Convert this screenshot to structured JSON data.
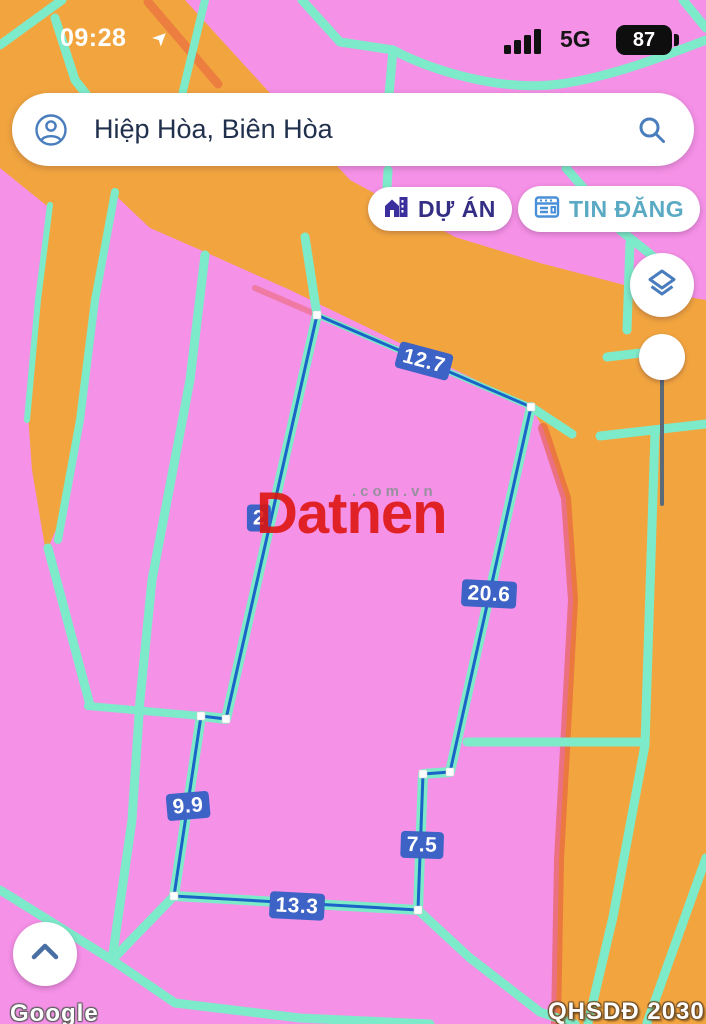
{
  "status_bar": {
    "time": "09:28",
    "network": "5G",
    "battery_percent": "87"
  },
  "search": {
    "value": "Hiệp Hòa, Biên Hòa"
  },
  "actions": {
    "du_an_label": "DỰ ÁN",
    "tin_dang_label": "TIN ĐĂNG"
  },
  "icons": {
    "account": "person-circle",
    "search": "magnifier",
    "du_an": "building",
    "tin_dang": "newspaper-listing",
    "map_layers": "stacked-layers",
    "collapse": "chevron-up",
    "location": "navigation-arrow"
  },
  "map": {
    "measurements": [
      {
        "text": "12.7",
        "x": 424,
        "y": 361,
        "rot": 15
      },
      {
        "text": "20.6",
        "x": 489,
        "y": 594,
        "rot": 3
      },
      {
        "text": "9.9",
        "x": 188,
        "y": 806,
        "rot": -5
      },
      {
        "text": "7.5",
        "x": 422,
        "y": 845,
        "rot": 2
      },
      {
        "text": "13.3",
        "x": 297,
        "y": 906,
        "rot": 3
      },
      {
        "text": "2",
        "x": 259,
        "y": 518,
        "rot": 0
      }
    ],
    "watermark_brand": "Datnen",
    "watermark_domain": ".com.vn",
    "map_credit": "Google",
    "layer_tag": "QHSDĐ 2030",
    "colors": {
      "residential_pink": "#F591E7",
      "planning_orange": "#F2A53F",
      "parcel_line_teal": "#7DEBC9",
      "boundary_red": "#E55A40",
      "plot_outline_blue": "#1A63C8",
      "label_blue": "#3E63C6"
    }
  }
}
